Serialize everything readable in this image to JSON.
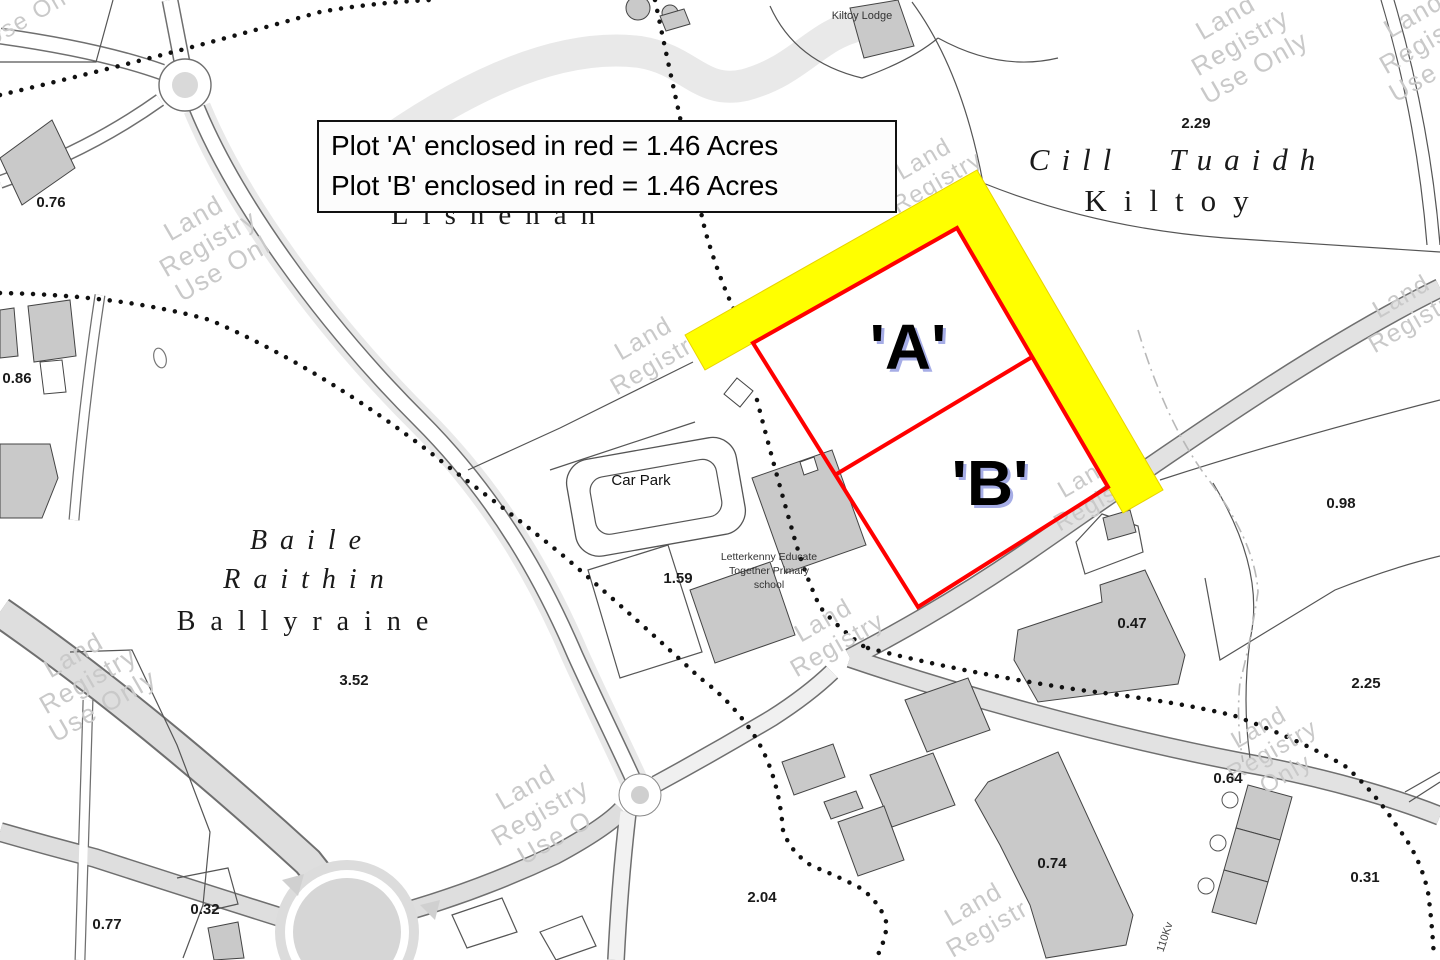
{
  "legend": {
    "line1": "Plot 'A' enclosed in red = 1.46 Acres",
    "line2": "Plot 'B' enclosed in red = 1.46 Acres"
  },
  "plots": {
    "a": "'A'",
    "b": "'B'"
  },
  "colors": {
    "plot_outline": "#ff0000",
    "highlight_band": "#ffff00",
    "building_fill": "#c9c9c9",
    "road_grey": "#dedede",
    "watermark_grey": "#c9c9c9"
  },
  "place_names": [
    {
      "text": "Cill Tuaidh",
      "x": 1178,
      "y": 170,
      "size": 31,
      "italic": true,
      "spacing": 12,
      "wspacing": 26
    },
    {
      "text": "Kiltoy",
      "x": 1175,
      "y": 211,
      "size": 31,
      "italic": false,
      "spacing": 17,
      "wspacing": 0
    },
    {
      "text": "Lisnenan",
      "x": 500,
      "y": 224,
      "size": 29,
      "italic": false,
      "spacing": 14,
      "wspacing": 0
    },
    {
      "text": "Baile",
      "x": 312,
      "y": 549,
      "size": 28,
      "italic": true,
      "spacing": 13,
      "wspacing": 0
    },
    {
      "text": "Raithin",
      "x": 310,
      "y": 588,
      "size": 28,
      "italic": true,
      "spacing": 13,
      "wspacing": 0
    },
    {
      "text": "Ballyraine",
      "x": 310,
      "y": 630,
      "size": 28,
      "italic": false,
      "spacing": 15,
      "wspacing": 0
    }
  ],
  "acreage_labels": [
    {
      "value": "0.76",
      "x": 51,
      "y": 207
    },
    {
      "value": "0.86",
      "x": 17,
      "y": 383
    },
    {
      "value": "2.29",
      "x": 1196,
      "y": 128
    },
    {
      "value": "0.98",
      "x": 1341,
      "y": 508
    },
    {
      "value": "1.59",
      "x": 678,
      "y": 583
    },
    {
      "value": "3.52",
      "x": 354,
      "y": 685
    },
    {
      "value": "0.47",
      "x": 1132,
      "y": 628
    },
    {
      "value": "2.25",
      "x": 1366,
      "y": 688
    },
    {
      "value": "0.64",
      "x": 1228,
      "y": 783
    },
    {
      "value": "0.31",
      "x": 1365,
      "y": 882
    },
    {
      "value": "0.74",
      "x": 1052,
      "y": 868
    },
    {
      "value": "2.04",
      "x": 762,
      "y": 902
    },
    {
      "value": "0.32",
      "x": 205,
      "y": 914
    },
    {
      "value": "0.77",
      "x": 107,
      "y": 929
    }
  ],
  "poi_labels": [
    {
      "text": "Car Park",
      "x": 641,
      "y": 485,
      "size": 15,
      "color": "#111111",
      "rot": 0,
      "bold": false
    },
    {
      "text": "Kiltoy Lodge",
      "x": 862,
      "y": 19,
      "size": 11,
      "color": "#333333",
      "rot": 0,
      "bold": false
    },
    {
      "text": "Letterkenny Educate",
      "x": 769,
      "y": 560,
      "size": 10.5,
      "color": "#333333",
      "rot": 0,
      "bold": false
    },
    {
      "text": "Together Primary",
      "x": 769,
      "y": 574,
      "size": 10.5,
      "color": "#333333",
      "rot": 0,
      "bold": false
    },
    {
      "text": "school",
      "x": 769,
      "y": 588,
      "size": 10.5,
      "color": "#333333",
      "rot": 0,
      "bold": false
    },
    {
      "text": "110Kv",
      "x": 1168,
      "y": 938,
      "size": 11,
      "color": "#444444",
      "rot": -72,
      "bold": false
    }
  ],
  "watermarks": [
    {
      "x": 25,
      "y": 18,
      "size": 24,
      "lines": [
        "Use On"
      ]
    },
    {
      "x": 208,
      "y": 243,
      "size": 26,
      "lines": [
        "Land",
        "Registry",
        "Use Onl"
      ]
    },
    {
      "x": 650,
      "y": 350,
      "size": 25,
      "lines": [
        "Land",
        "Registry"
      ]
    },
    {
      "x": 930,
      "y": 170,
      "size": 24,
      "lines": [
        "Land",
        "Registry"
      ]
    },
    {
      "x": 1240,
      "y": 42,
      "size": 26,
      "lines": [
        "Land",
        "Registry",
        "Use Only"
      ]
    },
    {
      "x": 1428,
      "y": 40,
      "size": 26,
      "lines": [
        "Land",
        "Registry",
        "Use Only"
      ]
    },
    {
      "x": 1408,
      "y": 308,
      "size": 25,
      "lines": [
        "Land",
        "Registry"
      ]
    },
    {
      "x": 1092,
      "y": 488,
      "size": 24,
      "lines": [
        "Land",
        "Registry"
      ]
    },
    {
      "x": 830,
      "y": 632,
      "size": 25,
      "lines": [
        "Land",
        "Registry"
      ]
    },
    {
      "x": 88,
      "y": 680,
      "size": 26,
      "lines": [
        "Land",
        "Registry",
        "Use Only"
      ]
    },
    {
      "x": 540,
      "y": 812,
      "size": 26,
      "lines": [
        "Land",
        "Registry",
        "Use O"
      ]
    },
    {
      "x": 980,
      "y": 916,
      "size": 25,
      "lines": [
        "Land",
        "Registr"
      ]
    },
    {
      "x": 1272,
      "y": 750,
      "size": 24,
      "lines": [
        "Land",
        "Registry",
        "Only"
      ]
    }
  ]
}
